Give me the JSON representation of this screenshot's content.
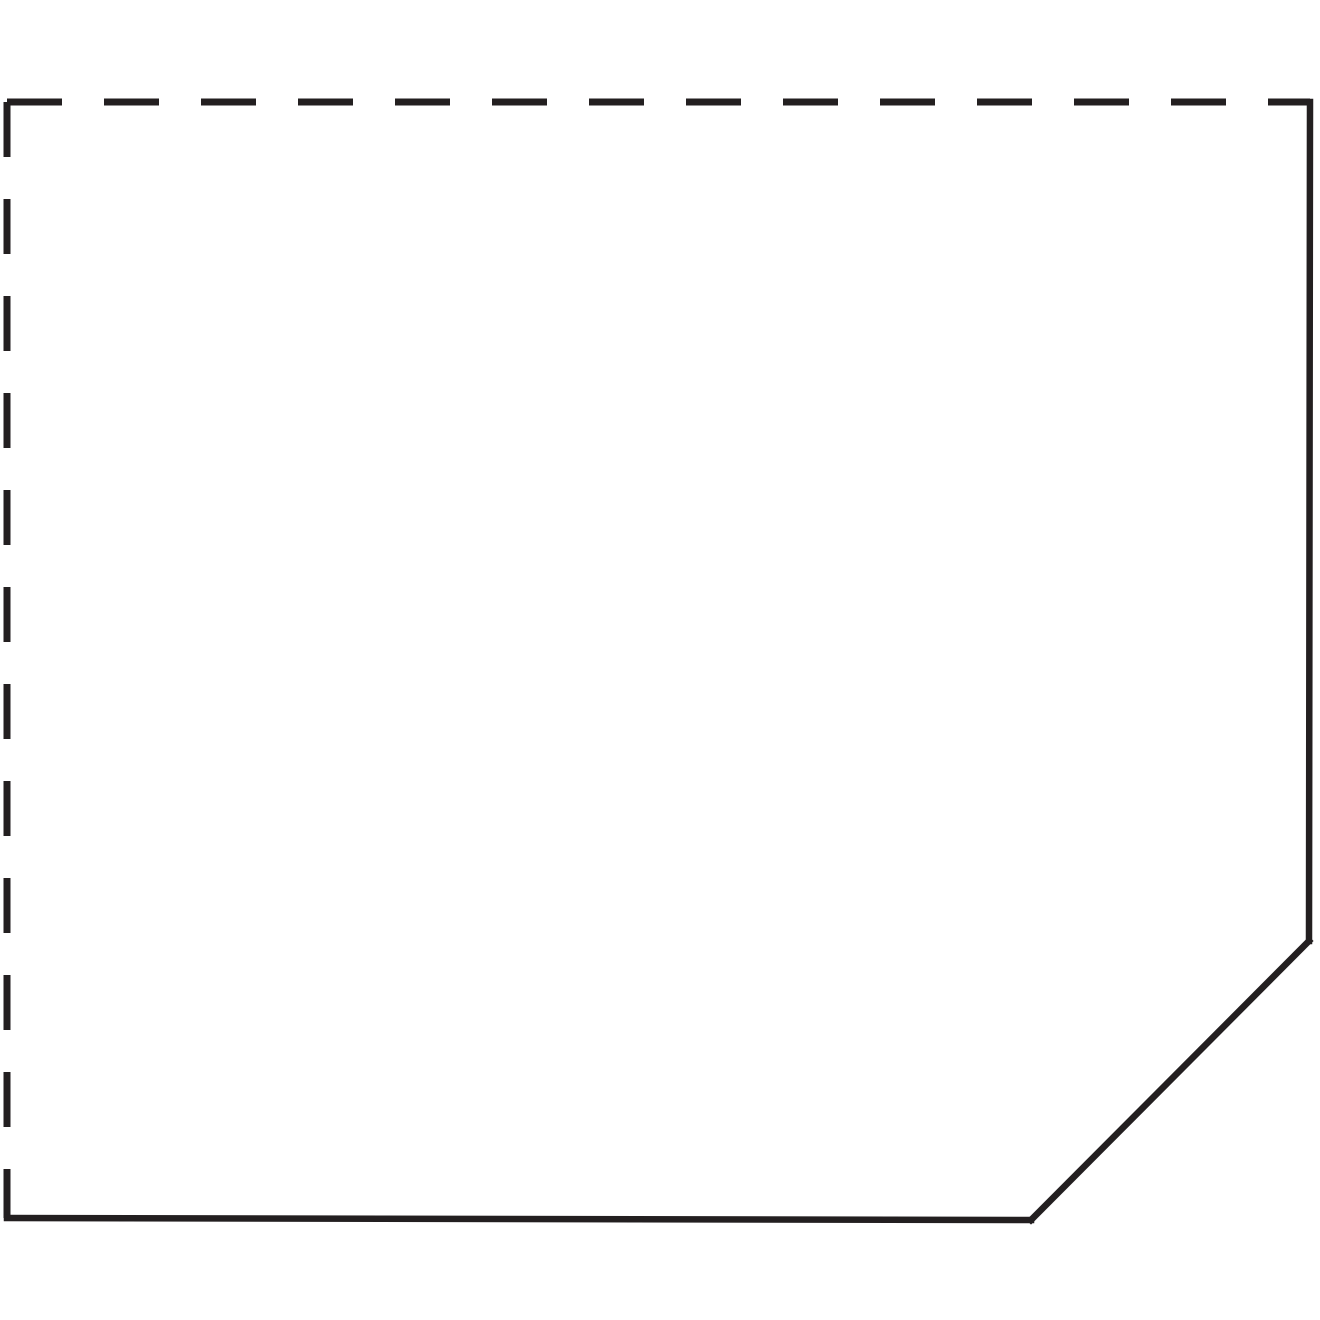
{
  "diagram": {
    "title": "panel-outline-with-beveled-corner",
    "background_color": "#ffffff",
    "stroke_color": "#231f20",
    "dashed_stroke_width": 7,
    "solid_stroke_width": 6.5,
    "dash_length": 55,
    "gap_length": 42,
    "canvas": {
      "width": 1320,
      "height": 1320
    },
    "vertices": {
      "top_left": [
        7,
        102
      ],
      "top_right": [
        1310,
        102
      ],
      "bevel_top": [
        1309,
        941
      ],
      "bevel_bottom": [
        1031,
        1220
      ],
      "bottom_left": [
        7,
        1218
      ]
    },
    "edges": [
      {
        "name": "top-edge",
        "style": "dashed",
        "from": "top_left",
        "to": "top_right"
      },
      {
        "name": "left-edge",
        "style": "dashed",
        "from": "top_left",
        "to": "bottom_left"
      },
      {
        "name": "right-edge",
        "style": "solid",
        "from": "top_right",
        "to": "bevel_top"
      },
      {
        "name": "bevel-edge",
        "style": "solid",
        "from": "bevel_top",
        "to": "bevel_bottom"
      },
      {
        "name": "bottom-edge",
        "style": "solid",
        "from": "bevel_bottom",
        "to": "bottom_left"
      }
    ]
  }
}
